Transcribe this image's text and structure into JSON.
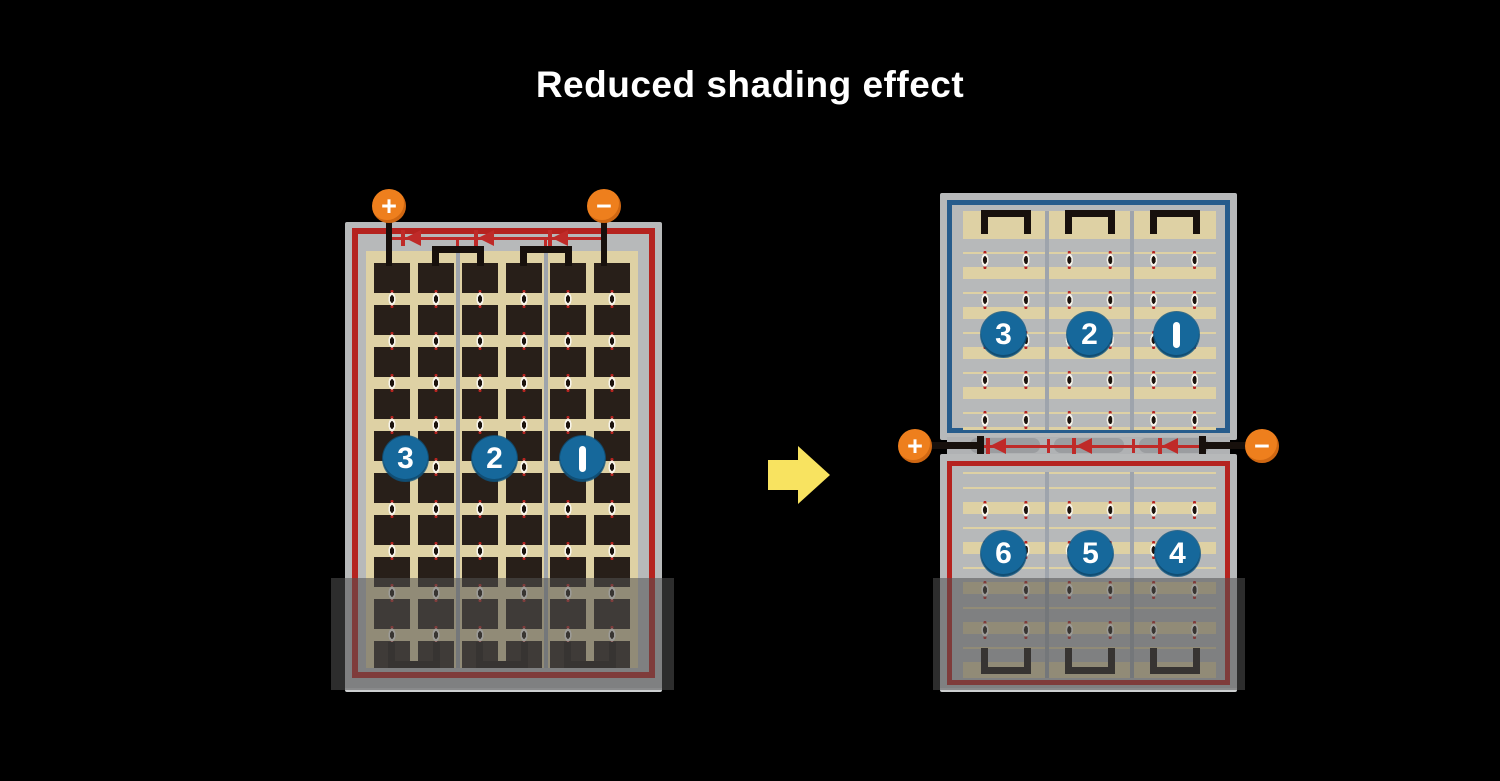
{
  "title": "Reduced shading effect",
  "left_module": {
    "description": "conventional full-cell module, serpentine strings, lower rows shaded",
    "terminals": {
      "positive": "+",
      "negative": "−"
    },
    "string_labels": [
      "3",
      "2",
      "1"
    ]
  },
  "right_module": {
    "description": "half-cut cell module split into top and bottom halves with center junction",
    "terminals": {
      "positive": "+",
      "negative": "−"
    },
    "top_string_labels": [
      "3",
      "2",
      "1"
    ],
    "bottom_string_labels": [
      "6",
      "5",
      "4"
    ]
  },
  "colors": {
    "background": "#000000",
    "title_text": "#ffffff",
    "terminal_orange": "#ee7f1d",
    "string_badge_blue": "#16689b",
    "wire_red": "#b5231f",
    "diode_red": "#bf2a28",
    "half_panel_blue_border": "#275c8c",
    "cell_dark": "#281f19",
    "cell_background_tan": "#ded1a4",
    "frame_gray": "#b7b9ba",
    "divider_gray": "#9ea4ac",
    "arrow_yellow": "#f8e360"
  }
}
